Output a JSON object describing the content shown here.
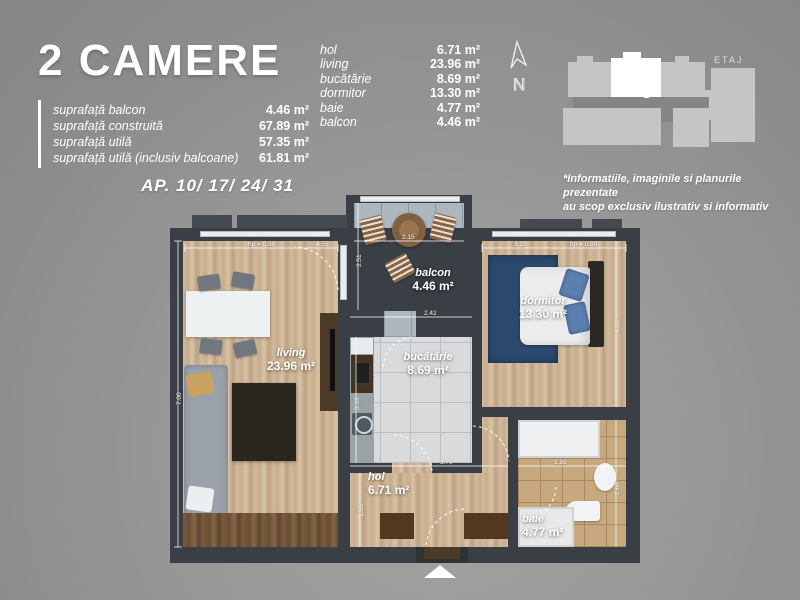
{
  "title": "2 CAMERE",
  "surfaces": [
    {
      "label": "suprafață balcon",
      "value": "4.46 m²"
    },
    {
      "label": "suprafață construită",
      "value": "67.89 m²"
    },
    {
      "label": "suprafață utilă",
      "value": "57.35 m²"
    },
    {
      "label": "suprafață utilă (inclusiv balcoane)",
      "value": "61.81 m²"
    }
  ],
  "ap": "AP. 10/ 17/ 24/ 31",
  "legend": [
    {
      "label": "hol",
      "value": "6.71 m²"
    },
    {
      "label": "living",
      "value": "23.96 m²"
    },
    {
      "label": "bucătărie",
      "value": "8.69 m²"
    },
    {
      "label": "dormitor",
      "value": "13.30 m²"
    },
    {
      "label": "baie",
      "value": "4.77 m²"
    },
    {
      "label": "balcon",
      "value": "4.46 m²"
    }
  ],
  "compass": {
    "north": "N"
  },
  "minimap": {
    "floor_label": "ETAJ"
  },
  "disclaimer": [
    "*Informatiile, imaginile si planurile prezentate",
    "au scop exclusiv ilustrativ si informativ"
  ],
  "plan_rooms": [
    {
      "name": "balcon",
      "area": "4.46 m²"
    },
    {
      "name": "living",
      "area": "23.96 m²"
    },
    {
      "name": "dormitor",
      "area": "13.30 m²"
    },
    {
      "name": "bucătărie",
      "area": "8.69 m²"
    },
    {
      "name": "hol",
      "area": "6.71 m²"
    },
    {
      "name": "baie",
      "area": "4.77 m²"
    }
  ],
  "dims": [
    "hp = 0.90",
    "4.55",
    "2.15",
    "2.51",
    "3.20",
    "hp = 0.90",
    "2.42",
    "7.00",
    "4.03",
    "3.70",
    "1.55",
    "1.85",
    "2.60",
    "3.33"
  ],
  "colors": {
    "wall": "#3a3e45",
    "wood": "#cdb394",
    "balcony_tile": "#adb7bf",
    "kitchen_tile": "#d9dadb",
    "bath_tile": "#c8a87e",
    "rug_blue": "#2c4a6e",
    "highlight_unit": "#ffffff",
    "text": "#ffffff"
  }
}
